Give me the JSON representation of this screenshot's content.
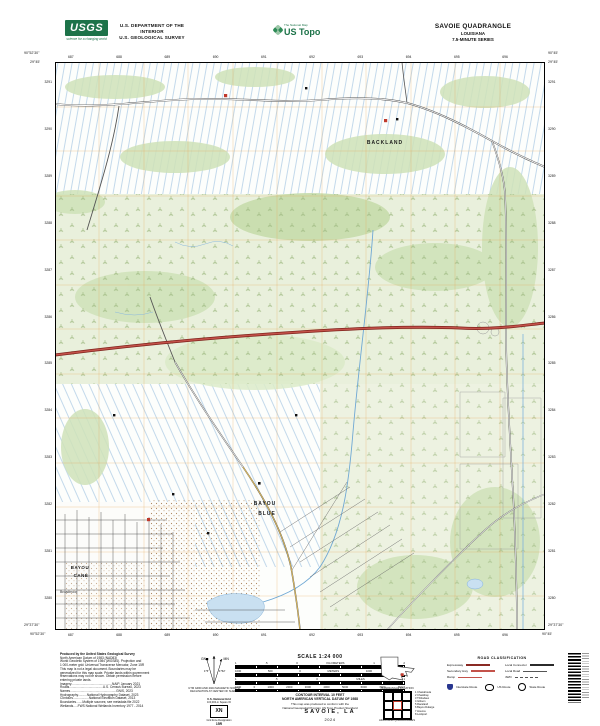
{
  "header": {
    "usgs_logo": "USGS",
    "usgs_tagline": "science for a changing world",
    "dept_line1": "U.S. DEPARTMENT OF THE INTERIOR",
    "dept_line2": "U.S. GEOLOGICAL SURVEY",
    "tnm_label": "The National Map",
    "brand": "US Topo",
    "quad_title": "SAVOIE QUADRANGLE",
    "state": "LOUISIANA",
    "series": "7.5-MINUTE SERIES"
  },
  "map": {
    "labels": {
      "backland": "BACKLAND",
      "bayou_1": "BAYOU",
      "blue": "BLUE",
      "bayou_2": "BAYOU",
      "cane": "CANE",
      "broadmoor": "Broadmoor"
    },
    "corners": {
      "tl_lon": "90°52'30\"",
      "tl_lat": "29°45'",
      "tr_lon": "90°45'",
      "tr_lat": "29°45'",
      "bl_lon": "90°52'30\"",
      "bl_lat": "29°37'30\"",
      "br_lon": "90°45'",
      "br_lat": "29°37'30\""
    },
    "grid_top": [
      "687",
      "688",
      "689",
      "690",
      "691",
      "692",
      "693",
      "694",
      "695",
      "696"
    ],
    "grid_left": [
      "3291",
      "3290",
      "3289",
      "3288",
      "3287",
      "3286",
      "3285",
      "3284",
      "3283",
      "3282",
      "3281",
      "3280"
    ]
  },
  "footer": {
    "produced_by": [
      "Produced by the United States Geological Survey",
      "North American Datum of 1983 (NAD83)",
      "World Geodetic System of 1984 (WGS84). Projection and",
      "1 000-meter grid: Universal Transverse Mercator, Zone 15R",
      "This map is not a legal document. Boundaries may be",
      "generalized for this map scale. Private lands within government",
      "reservations may not be shown. Obtain permission before",
      "entering private lands.",
      " ",
      "Imagery..............................................NAIP, January 2021",
      "Roads......................................U.S. Census Bureau, 2023",
      "Names....................................................GNIS, 2023",
      "Hydrography..........National Hydrography Dataset, 2023",
      "Contours..................National Elevation Dataset, 2013",
      "Boundaries.......Multiple sources; see metadata file 2022",
      "Wetlands.....FWS National Wetlands Inventory 1977 - 2014"
    ],
    "declination": {
      "gn": "GN",
      "mn": "MN",
      "gn_angle": "1°5'",
      "mn_angle": "1°52'",
      "caption1": "UTM GRID AND 2024 MAGNETIC NORTH",
      "caption2": "DECLINATION AT CENTER OF SHEET"
    },
    "usng": {
      "title": "U.S. National Grid",
      "subtitle": "100,000-m Square ID",
      "square": "XN",
      "gzd_label": "Grid Zone Designation",
      "gzd": "15R"
    },
    "scale": {
      "title": "SCALE 1:24 000",
      "km": [
        "1",
        ".5",
        "0",
        "KILOMETERS",
        "1",
        "2"
      ],
      "m": [
        "1000",
        "500",
        "0",
        "METERS",
        "1000",
        "2000"
      ],
      "mi": [
        "1",
        ".5",
        "0",
        "MILES",
        "1"
      ],
      "ft": [
        "1000",
        "0",
        "1000",
        "2000",
        "3000",
        "4000",
        "5000",
        "6000",
        "7000",
        "FEET"
      ],
      "contour1": "CONTOUR INTERVAL 10 FEET",
      "contour2": "NORTH AMERICAN VERTICAL DATUM OF 1988",
      "conform1": "This map was produced to conform with the",
      "conform2": "National Geospatial Program US Topo Product Standard"
    },
    "location": {
      "caption": "QUADRANGLE LOCATION"
    },
    "adjoining": {
      "caption": "ADJOINING QUADRANGLES",
      "quads": [
        "1 Chacahoula",
        "2 Chackbay",
        "3 Thibodaux",
        "4 Gibson",
        "5 Raceland",
        "6 Bayou Dularge",
        "7 Houma",
        "8 Lockport"
      ]
    },
    "roads": {
      "title": "ROAD CLASSIFICATION",
      "classes": [
        {
          "label": "Expressway"
        },
        {
          "label": "Secondary Hwy"
        },
        {
          "label": "Ramp"
        },
        {
          "label": "Local Connector"
        },
        {
          "label": "Local Road"
        },
        {
          "label": "4WD"
        }
      ],
      "shields": [
        {
          "label": "Interstate Route"
        },
        {
          "label": "US Route"
        },
        {
          "label": "State Route"
        }
      ]
    },
    "sheet": {
      "title": "SAVOIE, LA",
      "year": "2024"
    }
  },
  "colors": {
    "usgs_green": "#1d7349",
    "highway_red": "#b03a34",
    "water_blue": "#7fb3dc",
    "veg_green": "#cfe2b8",
    "grid_orange": "#e6a24f",
    "interstate_blue": "#28368f"
  }
}
